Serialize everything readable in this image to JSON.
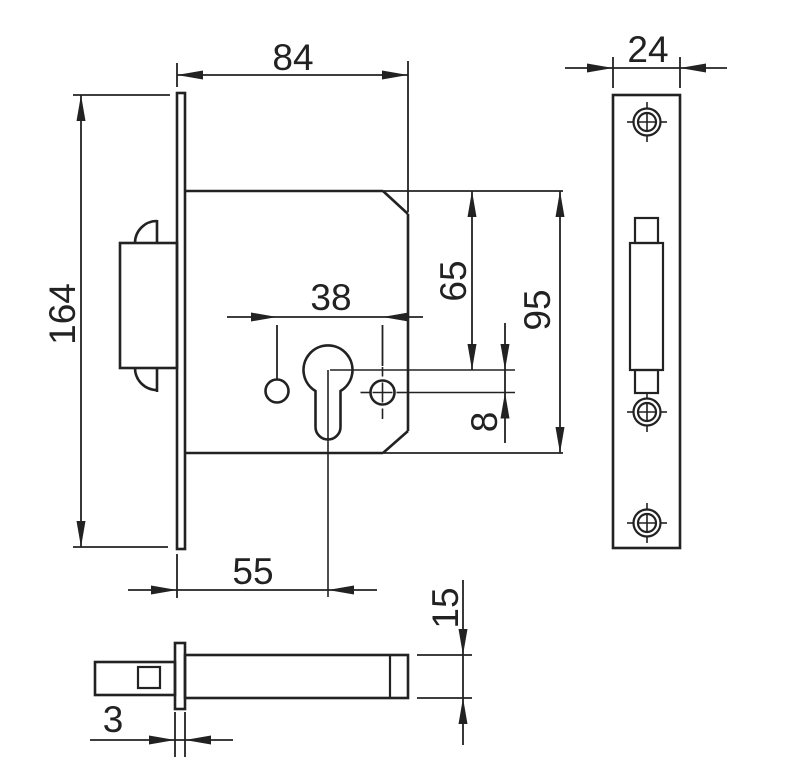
{
  "drawing": {
    "subject": "mortise deadbolt lock - dimensioned technical drawing",
    "colors": {
      "line": "#222222",
      "background": "#ffffff"
    },
    "dimensions": {
      "case_depth": "84",
      "faceplate_length": "164",
      "hole_spacing": "38",
      "top_to_cylinder_axis": "65",
      "case_height": "95",
      "cylinder_to_fixing_hole": "8",
      "backset": "55",
      "faceplate_width": "24",
      "bolt_thickness": "15",
      "faceplate_thickness": "3"
    }
  }
}
